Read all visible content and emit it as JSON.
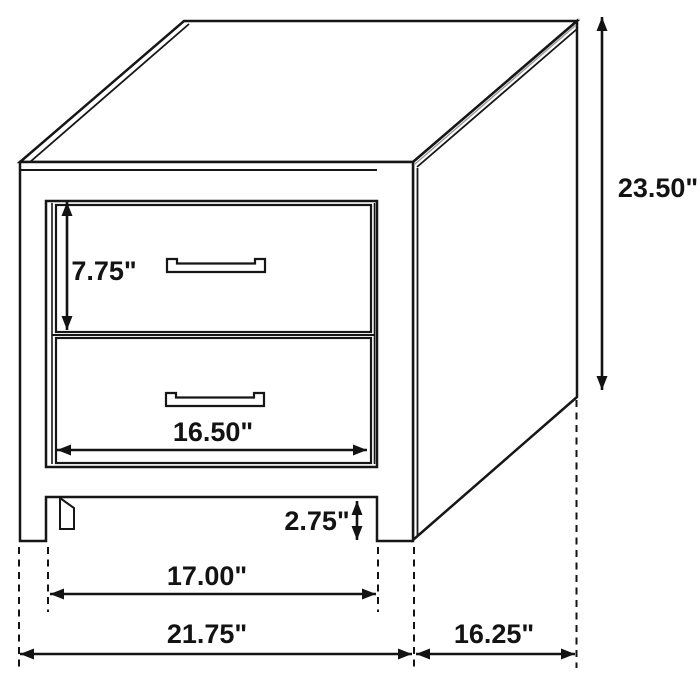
{
  "diagram": {
    "subject": "two-drawer nightstand dimension drawing",
    "style": {
      "line_color": "#161616",
      "background_color": "#ffffff",
      "shade_color": "#9a9a9a"
    },
    "unit": "inches",
    "dimensions": {
      "height": {
        "label": "23.50\""
      },
      "drawer_height": {
        "label": "7.75\""
      },
      "drawer_width": {
        "label": "16.50\""
      },
      "foot_height": {
        "label": "2.75\""
      },
      "inner_width": {
        "label": "17.00\""
      },
      "overall_width": {
        "label": "21.75\""
      },
      "side_depth": {
        "label": "16.25\""
      }
    }
  }
}
